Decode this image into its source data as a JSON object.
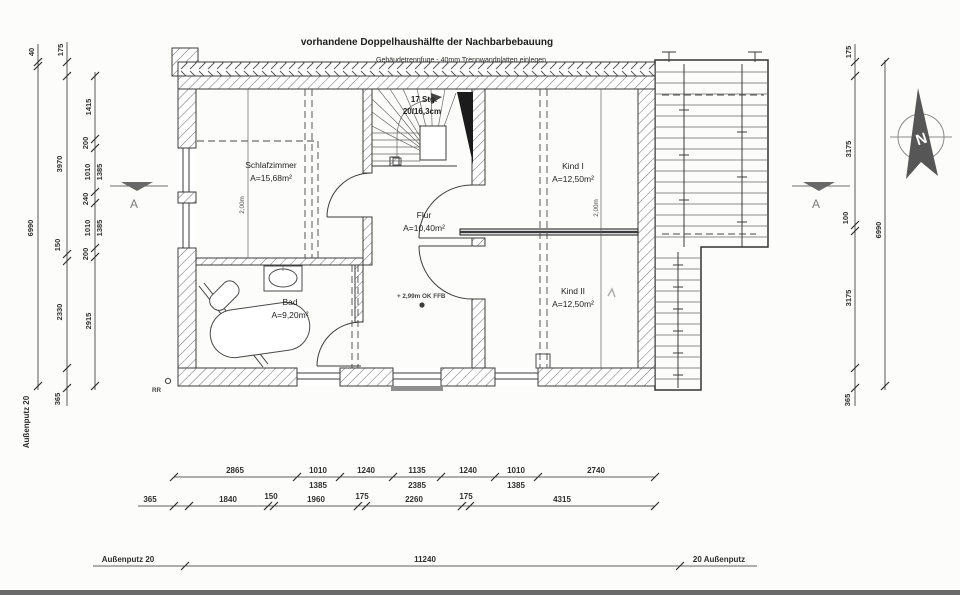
{
  "title": "vorhandene Doppelhaushälfte der Nachbarbebauung",
  "note": "Gebäudetrennfuge - 40mm Trennwandplatten einlegen",
  "rooms": {
    "schlafzimmer": {
      "name": "Schlafzimmer",
      "area": "A=15,68m²"
    },
    "flur": {
      "name": "Flur",
      "area": "A=10,40m²"
    },
    "bad": {
      "name": "Bad",
      "area": "A=9,20m²"
    },
    "kind1": {
      "name": "Kind I",
      "area": "A=12,50m²"
    },
    "kind2": {
      "name": "Kind II",
      "area": "A=12,50m²"
    }
  },
  "stair": {
    "steps": "17 Stg.",
    "rise": "20/16,3cm"
  },
  "labels": {
    "level": "+ 2,99m OK FFB",
    "rr": "RR",
    "height_line": "2,00m",
    "north": "N",
    "section": "A",
    "plaster_left": "Außenputz 20",
    "plaster_bottom_left": "Außenputz 20",
    "plaster_bottom_right": "20 Außenputz"
  },
  "dims": {
    "left_outer": [
      "40",
      "6990"
    ],
    "left_mid": [
      "175",
      "3970",
      "150",
      "2330",
      "365"
    ],
    "left_inner": [
      "1415",
      "200",
      "1010",
      "1385",
      "240",
      "1010",
      "1385",
      "200",
      "2915"
    ],
    "right_inner": [
      "175",
      "3175",
      "100",
      "3175",
      "365"
    ],
    "right_outer": [
      "6990"
    ],
    "bottom_row1": [
      "2865",
      "1010",
      "1385",
      "1240",
      "1135",
      "2385",
      "1240",
      "1010",
      "1385",
      "2740"
    ],
    "bottom_row2": [
      "365",
      "1840",
      "150",
      "1960",
      "175",
      "2260",
      "175",
      "4315"
    ],
    "bottom_total": "11240"
  }
}
